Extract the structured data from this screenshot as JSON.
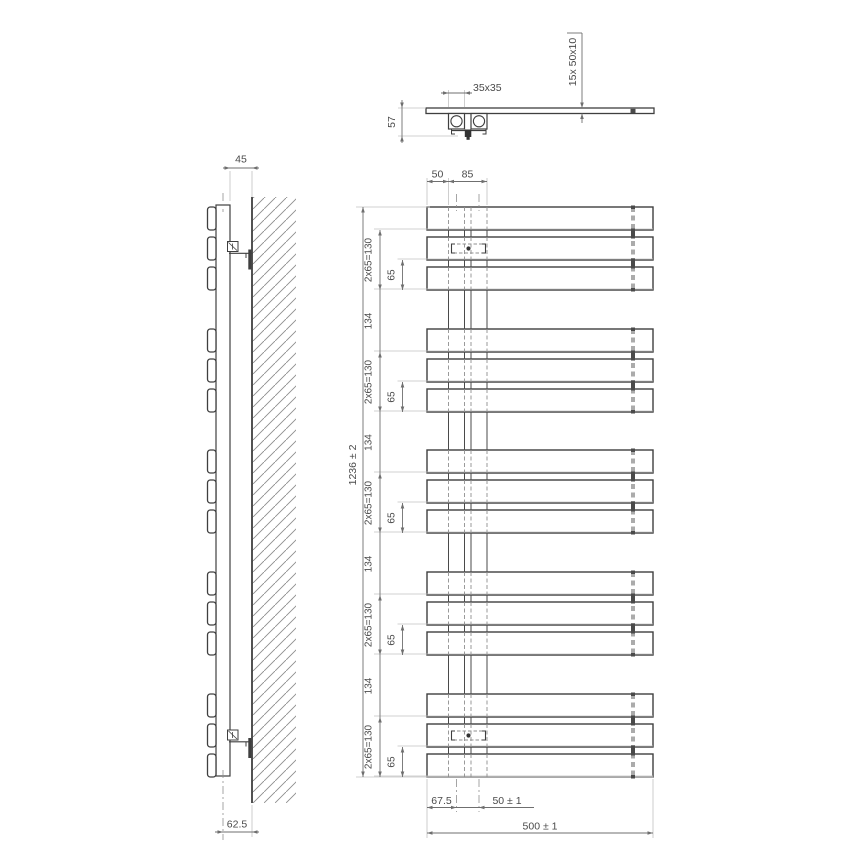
{
  "drawing_type": "towel-radiator-technical-drawing",
  "labels": {
    "top": {
      "bracket_size": "35x35",
      "depth": "57",
      "profile": "15x  50x10"
    },
    "front": {
      "pipe_offset": "50",
      "pipe_span": "85",
      "total_height": "1236 ± 2",
      "group_span": "2x65=130",
      "bar_spacing": "65",
      "group_gap": "134",
      "left_margin": "67.5",
      "pipe_pitch": "50 ± 1",
      "total_width": "500 ± 1"
    },
    "side": {
      "wall_gap": "45",
      "axis_depth": "62.5"
    }
  },
  "colors": {
    "bg": "#ffffff",
    "line": "#3f3f3f",
    "dim": "#6f6f6f",
    "ext": "#c2c2c2",
    "hidden": "#8f8f8f",
    "hidden2": "#ababab",
    "solid_gap": "#4a4a4a",
    "text": "#4a4a4a",
    "hatch": "#8d8d8d",
    "dark": "#333333"
  },
  "geom": {
    "front": {
      "left": 427,
      "right": 653,
      "bar_h": 23,
      "bar_tops": [
        207,
        237,
        267,
        329,
        359,
        389,
        450,
        480,
        510,
        572,
        602,
        632,
        694,
        724,
        754
      ],
      "pipe_xs": [
        448.5,
        464.5,
        471,
        487
      ],
      "pipe_centers": [
        456.5,
        479
      ],
      "connector_x": 633,
      "connector_w": 4,
      "bracket_x1": 451.5,
      "bracket_w": 34,
      "bracket_h": 9,
      "bracket_cx": 468.5,
      "bracket_bars": [
        1,
        13
      ],
      "dim_top_y": 181.5,
      "dim_top_ext_y": 178,
      "chain_x": 380,
      "chain65_x": 402.5,
      "total_x": 363,
      "ext_left": 374,
      "ext_left_outer": 356,
      "dim_bot1_y": 807.5,
      "dim_bot2_y": 833,
      "ext_bot_y": 838,
      "label50_x": 437.5,
      "label85_x": 467.5,
      "label_margin_x": 441.5,
      "label_pitch_x": 507,
      "label_width_x": 540
    },
    "side": {
      "tab_x": 207.5,
      "tab_w": 8.5,
      "pipe_x": 216,
      "pipe_w": 14,
      "pipe_top": 205,
      "pipe_bot": 776,
      "cl_x": 223,
      "wall_x": 252,
      "hatch_w": 44,
      "wall_top": 197,
      "wall_bot": 803,
      "bracket_ys": [
        241.5,
        730
      ],
      "dim45_y": 168,
      "dim45_x1": 230,
      "dim45_x2": 252,
      "dim625_y": 832,
      "dim625_x1": 223,
      "dim625_x2": 252
    },
    "top": {
      "strip_x": 426,
      "strip_w": 228,
      "strip_y": 108,
      "strip_h": 5.5,
      "sq_xs": [
        448.5,
        471
      ],
      "sq_w": 16,
      "sq_y": 113.5,
      "sq_h": 15.5,
      "circle_r": 5.6,
      "dot_x": 630.5,
      "dim35_y": 93,
      "dim35_x1": 448.5,
      "dim35_x2": 464.5,
      "dim57_x": 402,
      "dim57_y1": 108,
      "dim57_y2": 136,
      "profile_x": 582,
      "profile_top": 33
    }
  }
}
